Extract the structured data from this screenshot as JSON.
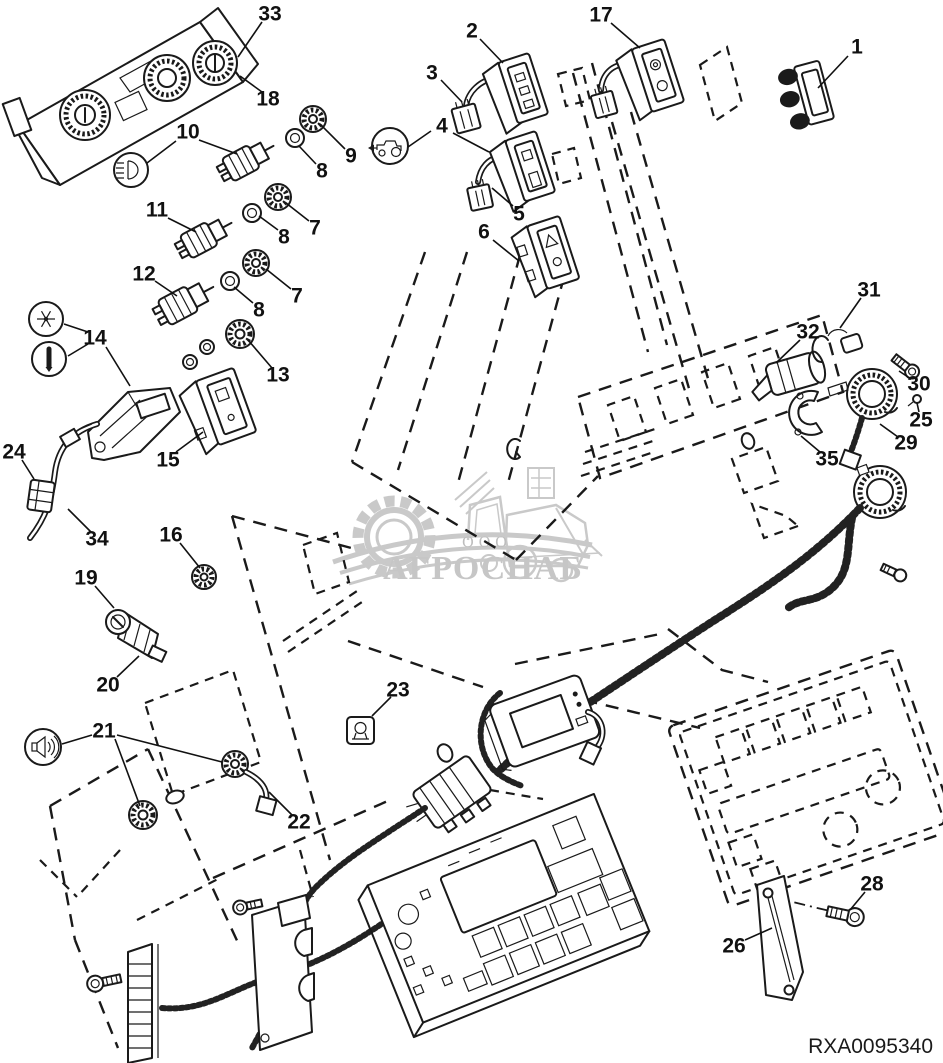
{
  "diagram": {
    "code": "RXA0095340",
    "kind": "exploded-parts-diagram"
  },
  "watermark": {
    "company_prefix": "ООО",
    "company_name": "АГРОСНАБ"
  },
  "colors": {
    "line": "#1a1a1a",
    "background": "#ffffff",
    "watermark": "#c9c9c9"
  },
  "icons": [
    "work-light-icon",
    "tractor-icon",
    "snowflake-icon",
    "dimmer-icon",
    "speaker-icon",
    "hazard-triangle-icon"
  ],
  "callouts": [
    {
      "num": "33",
      "x": 270,
      "y": 14,
      "leaders": [
        [
          262,
          22,
          238,
          57
        ]
      ]
    },
    {
      "num": "18",
      "x": 268,
      "y": 99,
      "leaders": [
        [
          262,
          92,
          240,
          76
        ]
      ]
    },
    {
      "num": "2",
      "x": 472,
      "y": 31,
      "leaders": [
        [
          480,
          39,
          503,
          63
        ]
      ]
    },
    {
      "num": "3",
      "x": 432,
      "y": 73,
      "leaders": [
        [
          441,
          80,
          462,
          102
        ]
      ]
    },
    {
      "num": "17",
      "x": 601,
      "y": 15,
      "leaders": [
        [
          611,
          23,
          640,
          48
        ]
      ]
    },
    {
      "num": "1",
      "x": 857,
      "y": 47,
      "leaders": [
        [
          848,
          56,
          818,
          88
        ]
      ]
    },
    {
      "num": "4",
      "x": 442,
      "y": 126,
      "leaders": [
        [
          453,
          133,
          489,
          152
        ],
        [
          408,
          147,
          431,
          131
        ]
      ]
    },
    {
      "num": "10",
      "x": 188,
      "y": 132,
      "leaders": [
        [
          199,
          140,
          237,
          154
        ],
        [
          147,
          163,
          176,
          141
        ]
      ]
    },
    {
      "num": "9",
      "x": 351,
      "y": 156,
      "leaders": [
        [
          345,
          149,
          320,
          124
        ]
      ]
    },
    {
      "num": "8",
      "x": 322,
      "y": 171,
      "leaders": [
        [
          316,
          164,
          299,
          146
        ]
      ]
    },
    {
      "num": "5",
      "x": 519,
      "y": 214,
      "leaders": [
        [
          513,
          206,
          492,
          188
        ]
      ]
    },
    {
      "num": "6",
      "x": 484,
      "y": 232,
      "leaders": [
        [
          493,
          240,
          519,
          261
        ]
      ]
    },
    {
      "num": "11",
      "x": 157,
      "y": 210,
      "leaders": [
        [
          168,
          218,
          196,
          232
        ]
      ]
    },
    {
      "num": "7",
      "x": 315,
      "y": 228,
      "leaders": [
        [
          309,
          221,
          286,
          203
        ]
      ]
    },
    {
      "num": "8",
      "x": 284,
      "y": 237,
      "leaders": [
        [
          278,
          230,
          259,
          216
        ]
      ]
    },
    {
      "num": "12",
      "x": 144,
      "y": 274,
      "leaders": [
        [
          155,
          281,
          177,
          296
        ]
      ]
    },
    {
      "num": "7",
      "x": 297,
      "y": 296,
      "leaders": [
        [
          291,
          289,
          266,
          269
        ]
      ]
    },
    {
      "num": "8",
      "x": 259,
      "y": 310,
      "leaders": [
        [
          253,
          303,
          234,
          287
        ]
      ]
    },
    {
      "num": "31",
      "x": 869,
      "y": 290,
      "leaders": [
        [
          861,
          298,
          840,
          328
        ]
      ]
    },
    {
      "num": "32",
      "x": 808,
      "y": 332,
      "leaders": [
        [
          800,
          340,
          776,
          363
        ]
      ]
    },
    {
      "num": "14",
      "x": 95,
      "y": 338,
      "leaders": [
        [
          88,
          332,
          64,
          324
        ],
        [
          88,
          344,
          68,
          356
        ],
        [
          106,
          347,
          130,
          386
        ]
      ]
    },
    {
      "num": "13",
      "x": 278,
      "y": 375,
      "leaders": [
        [
          272,
          368,
          248,
          340
        ]
      ]
    },
    {
      "num": "30",
      "x": 919,
      "y": 384,
      "leaders": [
        [
          911,
          379,
          899,
          371
        ]
      ]
    },
    {
      "num": "25",
      "x": 921,
      "y": 420,
      "leaders": [
        [
          919,
          412,
          917,
          403
        ]
      ]
    },
    {
      "num": "29",
      "x": 906,
      "y": 443,
      "leaders": [
        [
          898,
          437,
          880,
          424
        ]
      ]
    },
    {
      "num": "35",
      "x": 827,
      "y": 459,
      "leaders": [
        [
          820,
          452,
          801,
          436
        ]
      ]
    },
    {
      "num": "24",
      "x": 14,
      "y": 452,
      "leaders": [
        [
          22,
          460,
          34,
          479
        ]
      ]
    },
    {
      "num": "15",
      "x": 168,
      "y": 460,
      "leaders": [
        [
          176,
          452,
          203,
          432
        ]
      ]
    },
    {
      "num": "34",
      "x": 97,
      "y": 539,
      "leaders": [
        [
          91,
          532,
          68,
          509
        ]
      ]
    },
    {
      "num": "16",
      "x": 171,
      "y": 535,
      "leaders": [
        [
          180,
          543,
          200,
          568
        ]
      ]
    },
    {
      "num": "19",
      "x": 86,
      "y": 578,
      "leaders": [
        [
          95,
          586,
          114,
          608
        ]
      ]
    },
    {
      "num": "20",
      "x": 108,
      "y": 685,
      "leaders": [
        [
          117,
          677,
          139,
          656
        ]
      ]
    },
    {
      "num": "21",
      "x": 104,
      "y": 731,
      "leaders": [
        [
          92,
          735,
          62,
          744
        ],
        [
          115,
          739,
          140,
          806
        ],
        [
          117,
          735,
          222,
          762
        ]
      ]
    },
    {
      "num": "23",
      "x": 398,
      "y": 690,
      "leaders": [
        [
          391,
          697,
          372,
          716
        ]
      ]
    },
    {
      "num": "22",
      "x": 299,
      "y": 822,
      "leaders": [
        [
          292,
          815,
          269,
          792
        ]
      ]
    },
    {
      "num": "26",
      "x": 734,
      "y": 946,
      "leaders": [
        [
          745,
          940,
          772,
          928
        ]
      ]
    },
    {
      "num": "28",
      "x": 872,
      "y": 884,
      "leaders": [
        [
          865,
          892,
          850,
          910
        ]
      ]
    }
  ]
}
